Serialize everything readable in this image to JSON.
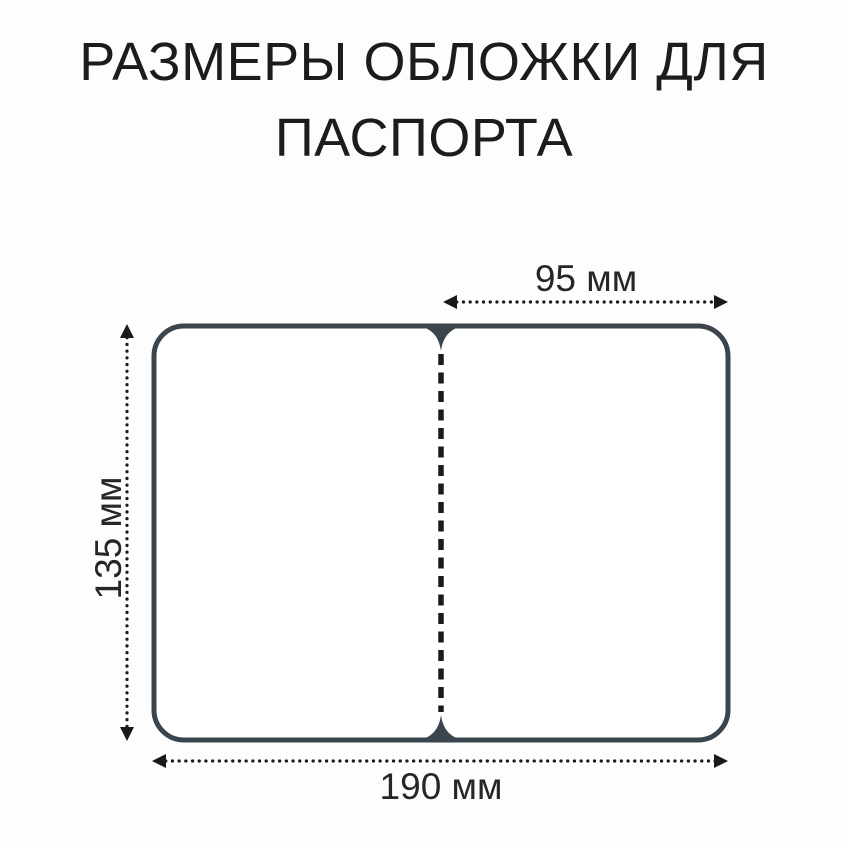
{
  "title": {
    "line1": "РАЗМЕРЫ ОБЛОЖКИ ДЛЯ",
    "line2": "ПАСПОРТА"
  },
  "diagram": {
    "subject": "passport-cover-open-flat",
    "cover": {
      "outline_color": "#3a454e",
      "fill_color": "#ffffff",
      "fold": "dashed-center-line"
    },
    "dimensions": {
      "width_half": {
        "value": 95,
        "unit": "мм",
        "label": "95 мм"
      },
      "height": {
        "value": 135,
        "unit": "мм",
        "label": "135 мм"
      },
      "width_full": {
        "value": 190,
        "unit": "мм",
        "label": "190 мм"
      }
    },
    "colors": {
      "dimension_line": "#1a1a1a",
      "label_text": "#262626",
      "title_text": "#1c1c1c",
      "background": "#fdfdfd"
    }
  }
}
